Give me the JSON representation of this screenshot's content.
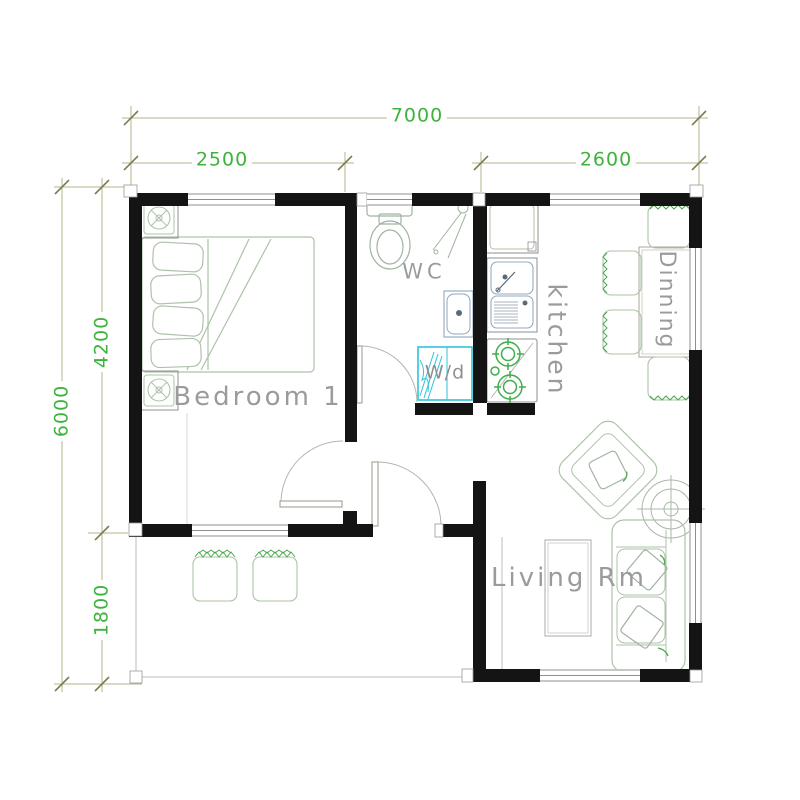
{
  "dimensions": {
    "total_width": "7000",
    "bedroom_width": "2500",
    "dining_width": "2600",
    "total_depth": "6000",
    "main_depth": "4200",
    "terrace_depth": "1800"
  },
  "room_labels": {
    "bedroom": "Bedroom 1",
    "wc": "WC",
    "washer_dryer": "W/d",
    "kitchen": "kitchen",
    "dining": "Dinning",
    "living": "Living Rm"
  },
  "colors": {
    "dimension_text": "#3cb43c",
    "dimension_line": "#b3b388",
    "dimension_tick": "#7d7d55",
    "wall": "#141414",
    "furniture_outline": "#adc3a9",
    "accent_green": "#49a84d",
    "washer_cyan": "#2fc3da",
    "kitchen_fixture": "#93a9bd",
    "label_gray": "#9b9b9b",
    "window_line": "#8f8f8f"
  }
}
